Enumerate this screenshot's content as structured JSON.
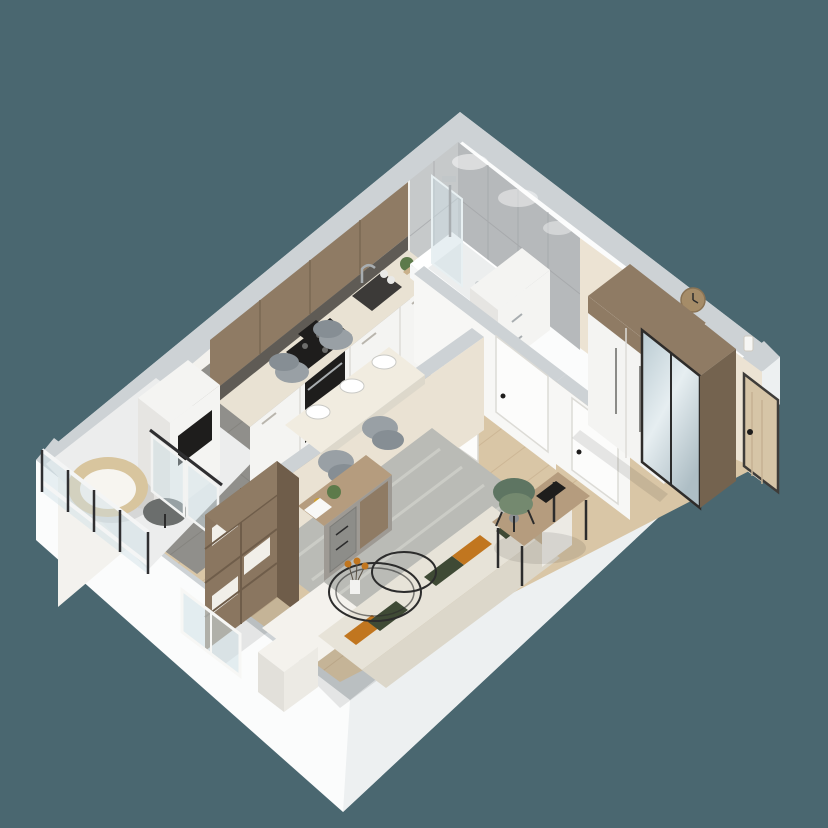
{
  "meta": {
    "alt": "3D isometric cutaway render of a small apartment floor plan on a slate teal background",
    "view": "isometric top-down render",
    "visible_text": "none"
  },
  "colors": {
    "backdrop": "#4a6770",
    "wall_outer": "#fbfcfc",
    "wall_outer_shade": "#edf0f1",
    "wall_cap": "#cdd2d5",
    "wall_beige": "#ece3d3",
    "wall_white_inner": "#f3f2ee",
    "tile_marble": "#b6b9bb",
    "tile_marble_light": "#c6c9ca",
    "floor_wood": "#d9c6a6",
    "floor_wood_line": "#c2ab89",
    "floor_tile": "#908f8b",
    "floor_tile_line": "#7e7d78",
    "floor_bath": "#77787a",
    "cabinet_white": "#f4f4f2",
    "cabinet_side": "#e6e5e2",
    "counter": "#e9e2d3",
    "backsplash": "#5f5b55",
    "wood_cabinet": "#8f7b64",
    "wood_dark": "#74634f",
    "wood_light": "#b59c7e",
    "appliance": "#1e1d1c",
    "steel": "#a8adb0",
    "chair_gray": "#99a0a5",
    "chair_gray_dark": "#868e94",
    "halfwall": "#eae2d3",
    "sofa": "#e7e3d8",
    "sofa_back": "#dcd7ca",
    "sofa_white": "#f4f2ed",
    "pillow_orange": "#c1761f",
    "pillow_green": "#3f4a35",
    "rug": "#babbb6",
    "rug_light": "#cbccc6",
    "shelf_wood": "#8a7660",
    "shelf_side": "#6f5d4a",
    "door_white": "#f7f7f5",
    "door_wood": "#d6c5a7",
    "glass": "#cfe0e6",
    "rail_dark": "#2f2f31",
    "wicker": "#d8c59e",
    "cushion": "#f7f5f0",
    "side_table": "#6b6e6d",
    "clock": "#a58c68",
    "chair_green": "#5e7562",
    "chair_green2": "#74896f",
    "plant": "#5d7a4a",
    "line_dark": "#2c2c2c"
  },
  "rooms": [
    {
      "name": "bathroom",
      "items": [
        "bathtub",
        "glass shower screen",
        "shower column",
        "marble tile walls",
        "storage cabinet",
        "spotlights"
      ]
    },
    {
      "name": "kitchen",
      "items": [
        "wood upper cabinets",
        "white base cabinets",
        "tall cabinet column",
        "cooktop",
        "built-in oven",
        "microwave",
        "sink",
        "faucet",
        "plant",
        "glassware"
      ]
    },
    {
      "name": "dining-area",
      "items": [
        "dining table",
        "gray upholstered chairs",
        "place settings",
        "half wall"
      ]
    },
    {
      "name": "hallway",
      "items": [
        "open kitchen door",
        "bathroom door",
        "storage door",
        "wood laminate floor"
      ]
    },
    {
      "name": "entry-hall",
      "items": [
        "white wardrobe",
        "mirrored wardrobe",
        "wood wall clock",
        "entrance door",
        "intercom panel"
      ]
    },
    {
      "name": "living-room",
      "items": [
        "corner sofa",
        "orange pillows",
        "green pillows",
        "wire coffee table",
        "flower vase",
        "area rug",
        "open bookshelf",
        "sideboard",
        "desk",
        "green desk chair",
        "window"
      ]
    },
    {
      "name": "balcony",
      "items": [
        "glass railing",
        "papasan wicker chair",
        "round side table",
        "glass partition doors"
      ]
    }
  ]
}
